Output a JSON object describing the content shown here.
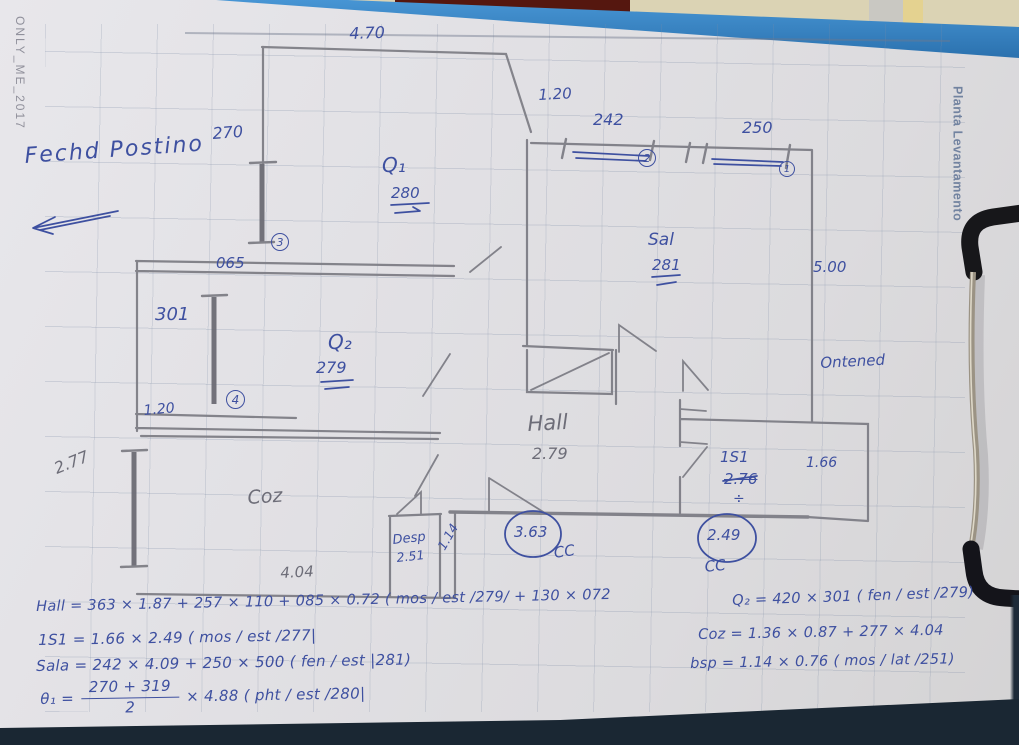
{
  "colors": {
    "ink": "#3e50a0",
    "pencil": "#6d6d78",
    "clipboard_blue": "#2f7fc0",
    "paper": "#e0dfe3",
    "wall_beige": "#dbd3b4",
    "board_edge": "#1a2733"
  },
  "stamps": {
    "left": "ONLY_ME_2017",
    "right": "Planta Levantamento"
  },
  "note": {
    "text": "Fechd Postino"
  },
  "plan": {
    "l470": "4.70",
    "l270": "270",
    "l120_top": "1.20",
    "l242": "242",
    "l250": "250",
    "q1": "Q₁",
    "l280": "280",
    "l065": "065",
    "l301": "301",
    "q2": "Q₂",
    "l279": "279",
    "l120_left": "1.20",
    "sal": "Sal",
    "l281": "281",
    "l500": "5.00",
    "ontened": "Ontened",
    "hall": "Hall",
    "l279_hall": "2.79",
    "s1": "1S1",
    "l276": "2.76",
    "div276": "÷",
    "l166": "1.66",
    "l277": "2.77",
    "coz": "Coz",
    "desp": "Desp",
    "l251": "2.51",
    "l114": "1.14",
    "l404": "4.04",
    "cc_a": "CC",
    "cc_b": "CC",
    "val363": "3.63",
    "val249": "2.49",
    "ref1": "1",
    "ref2": "2",
    "ref3": "3",
    "ref4": "4"
  },
  "formulas": {
    "hall": "Hall = 363 × 1.87 + 257 × 110 + 085 × 0.72 ( mos / est /279/ + 130 × 072",
    "s1": "1S1 = 1.66 × 2.49 ( mos / est /277|",
    "sala": "Sala = 242 × 4.09 + 250 × 500 ( fen / est |281)",
    "theta_prefix": "θ₁ =",
    "theta_num": "270 + 319",
    "theta_den": "2",
    "theta_suffix": "× 4.88 ( pht / est /280|",
    "q2": "Q₂ = 420 × 301 ( fen / est /279)",
    "coz": "Coz = 1.36 × 0.87 + 277 × 4.04",
    "dsp": "bsp = 1.14 × 0.76 ( mos / lat /251)"
  }
}
